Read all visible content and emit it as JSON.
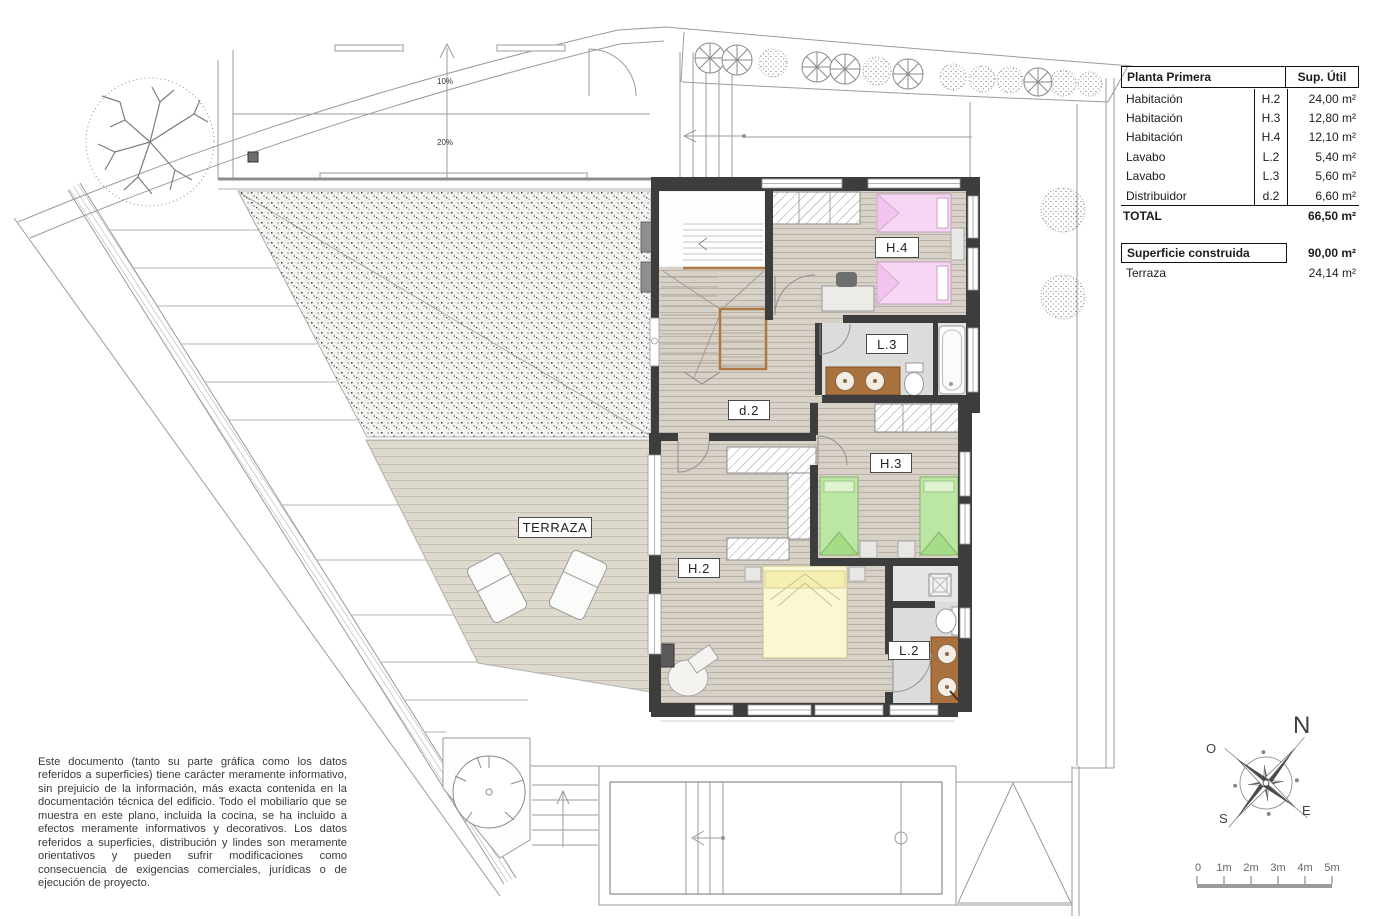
{
  "plan": {
    "room_labels": {
      "h2": "H.2",
      "h3": "H.3",
      "h4": "H.4",
      "l2": "L.2",
      "l3": "L.3",
      "d2": "d.2",
      "terrace": "TERRAZA"
    },
    "slope_labels": {
      "upper": "10%",
      "lower": "20%"
    }
  },
  "area_table": {
    "header": {
      "title": "Planta Primera",
      "area_col": "Sup. Útil"
    },
    "rows": [
      {
        "name": "Habitación",
        "code": "H.2",
        "area": "24,00 m²"
      },
      {
        "name": "Habitación",
        "code": "H.3",
        "area": "12,80 m²"
      },
      {
        "name": "Habitación",
        "code": "H.4",
        "area": "12,10 m²"
      },
      {
        "name": "Lavabo",
        "code": "L.2",
        "area": "5,40 m²"
      },
      {
        "name": "Lavabo",
        "code": "L.3",
        "area": "5,60 m²"
      },
      {
        "name": "Distribuidor",
        "code": "d.2",
        "area": "6,60 m²"
      }
    ],
    "total": {
      "label": "TOTAL",
      "area": "66,50 m²"
    },
    "built": {
      "label": "Superficie construida",
      "area": "90,00 m²"
    },
    "terrace_row": {
      "label": "Terraza",
      "area": "24,14 m²"
    }
  },
  "compass": {
    "north": "N",
    "west": "O",
    "south": "S",
    "east": "E"
  },
  "scale_bar": {
    "labels": [
      "0",
      "1m",
      "2m",
      "3m",
      "4m",
      "5m"
    ]
  },
  "disclaimer": "Este documento (tanto su parte gráfica como los datos referidos a superficies) tiene carácter meramente informativo, sin prejuicio de la información, más exacta contenida en la documentación técnica del edificio. Todo el mobiliario que se muestra en este plano, incluida la cocina, se ha incluido a efectos meramente informativos y decorativos. Los datos referidos a superficies, distribución y lindes son meramente orientativos y pueden sufrir modificaciones como consecuencia de exigencias comerciales, jurídicas o de ejecución de proyecto.",
  "colors": {
    "wall": "#3d3d3d",
    "floor_wood": "#d7d1c7",
    "terrace_deck": "#ded9cd",
    "bath_floor": "#dcdcda",
    "bed_pink": "#f6d6f3",
    "bed_green": "#bce6a4",
    "bed_yellow": "#faf8d3",
    "vanity_wood": "#a9713e"
  }
}
